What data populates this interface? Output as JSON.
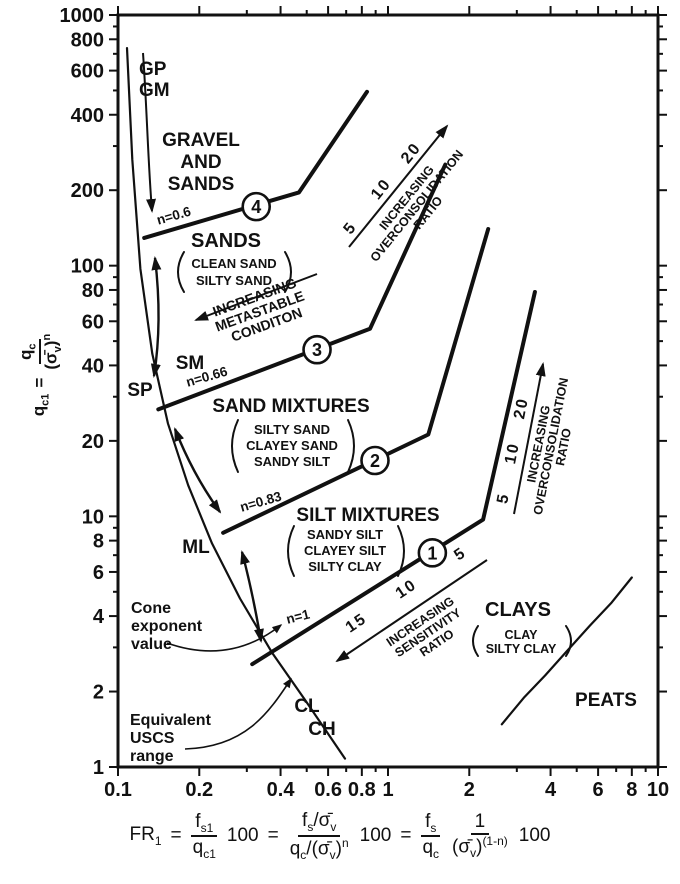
{
  "chart_data": {
    "type": "line",
    "x_axis": {
      "scale": "log",
      "range": [
        0.1,
        10
      ],
      "tick_labels": [
        "0.1",
        "0.2",
        "0.4",
        "0.6",
        "0.8",
        "1",
        "2",
        "4",
        "6",
        "8",
        "10"
      ]
    },
    "y_axis": {
      "scale": "log",
      "range": [
        1,
        1000
      ],
      "tick_labels": [
        "1000",
        "800",
        "600",
        "400",
        "200",
        "100",
        "80",
        "60",
        "40",
        "20",
        "10",
        "8",
        "6",
        "4",
        "2",
        "1"
      ]
    },
    "series": [
      {
        "name": "boundary-1",
        "kind": "boundary",
        "n_label": "n=1",
        "points": [
          [
            0.314,
            2.57
          ],
          [
            2.25,
            9.7
          ],
          [
            3.5,
            78.5
          ]
        ]
      },
      {
        "name": "boundary-2",
        "kind": "boundary",
        "n_label": "n=0.83",
        "points": [
          [
            0.245,
            8.6
          ],
          [
            1.41,
            21.2
          ],
          [
            2.35,
            140
          ]
        ]
      },
      {
        "name": "boundary-3",
        "kind": "boundary",
        "n_label": "n=0.66",
        "points": [
          [
            0.141,
            26.7
          ],
          [
            0.858,
            56
          ],
          [
            1.63,
            253
          ]
        ]
      },
      {
        "name": "boundary-4",
        "kind": "boundary",
        "n_label": "n=0.6",
        "points": [
          [
            0.125,
            129
          ],
          [
            0.468,
            196
          ],
          [
            0.836,
            494
          ]
        ]
      },
      {
        "name": "uscs-range-curve",
        "kind": "curve",
        "points": [
          [
            0.108,
            738
          ],
          [
            0.113,
            265
          ],
          [
            0.121,
            97
          ],
          [
            0.134,
            44.5
          ],
          [
            0.153,
            23.5
          ],
          [
            0.182,
            13.3
          ],
          [
            0.223,
            7.8
          ],
          [
            0.283,
            4.7
          ],
          [
            0.372,
            2.86
          ],
          [
            0.493,
            1.85
          ],
          [
            0.693,
            1.08
          ]
        ]
      },
      {
        "name": "peats-curve",
        "kind": "curve",
        "points": [
          [
            2.64,
            1.48
          ],
          [
            3.2,
            1.9
          ],
          [
            3.82,
            2.32
          ],
          [
            4.6,
            2.9
          ],
          [
            5.6,
            3.67
          ],
          [
            6.7,
            4.5
          ],
          [
            8.0,
            5.7
          ]
        ]
      }
    ],
    "markers": [
      {
        "label": "1",
        "fr": 1.46,
        "q": 7.15
      },
      {
        "label": "2",
        "fr": 0.895,
        "q": 16.7
      },
      {
        "label": "3",
        "fr": 0.546,
        "q": 46.2
      },
      {
        "label": "4",
        "fr": 0.325,
        "q": 172
      }
    ]
  },
  "labels": {
    "gp": "GP",
    "gm": "GM",
    "gravel": {
      "l1": "GRAVEL",
      "l2": "AND",
      "l3": "SANDS"
    },
    "sands": {
      "title": "SANDS",
      "s1": "CLEAN SAND",
      "s2": "SILTY SAND"
    },
    "sand_mixtures": {
      "title": "SAND MIXTURES",
      "s1": "SILTY SAND",
      "s2": "CLAYEY SAND",
      "s3": "SANDY SILT"
    },
    "silt_mixtures": {
      "title": "SILT MIXTURES",
      "s1": "SANDY SILT",
      "s2": "CLAYEY SILT",
      "s3": "SILTY CLAY"
    },
    "clays": {
      "title": "CLAYS",
      "s1": "CLAY",
      "s2": "SILTY CLAY"
    },
    "peats": "PEATS",
    "sm": "SM",
    "sp": "SP",
    "ml": "ML",
    "cl": "CL",
    "ch": "CH",
    "n4": "n=0.6",
    "n3": "n=0.66",
    "n2": "n=0.83",
    "n1": "n=1"
  },
  "annotations": {
    "metastable": {
      "l1": "INCREASING",
      "l2": "METASTABLE",
      "l3": "CONDITON"
    },
    "ocr": {
      "l1": "INCREASING",
      "l2": "OVERCONSOLIDATION",
      "l3": "RATIO",
      "v1": "5",
      "v2": "10",
      "v3": "20"
    },
    "sensitivity": {
      "l1": "INCREASING",
      "l2": "SENSITIVITY",
      "l3": "RATIO",
      "v1": "5",
      "v2": "10",
      "v3": "15"
    },
    "cone_exponent": {
      "l1": "Cone",
      "l2": "exponent",
      "l3": "value"
    },
    "uscs_range": {
      "l1": "Equivalent",
      "l2": "USCS",
      "l3": "range"
    }
  },
  "y_title": {
    "lhs": "q",
    "lhs_sub": "c1",
    "eq": "=",
    "num": "q",
    "num_sub": "c",
    "den_a": "(σ̄",
    "den_sub": "v",
    "den_b": ")",
    "den_exp": "n"
  },
  "formula": {
    "lhs": "FR",
    "lhs_sub": "1",
    "eq": "=",
    "hundred": "100",
    "f1n": "f",
    "f1ns": "s1",
    "f1d": "q",
    "f1ds": "c1",
    "f2na": "f",
    "f2nas": "s",
    "f2nb": "/σ̄",
    "f2nbs": "v",
    "f2da": "q",
    "f2das": "c",
    "f2db": "/(σ̄",
    "f2dbs": "v",
    "f2dc": ")",
    "f2dexp": "n",
    "f3n": "f",
    "f3ns": "s",
    "f3d": "q",
    "f3ds": "c",
    "f4n": "1",
    "f4da": "(σ̄",
    "f4das": "v",
    "f4db": ")",
    "f4dexp": "(1-n)"
  }
}
